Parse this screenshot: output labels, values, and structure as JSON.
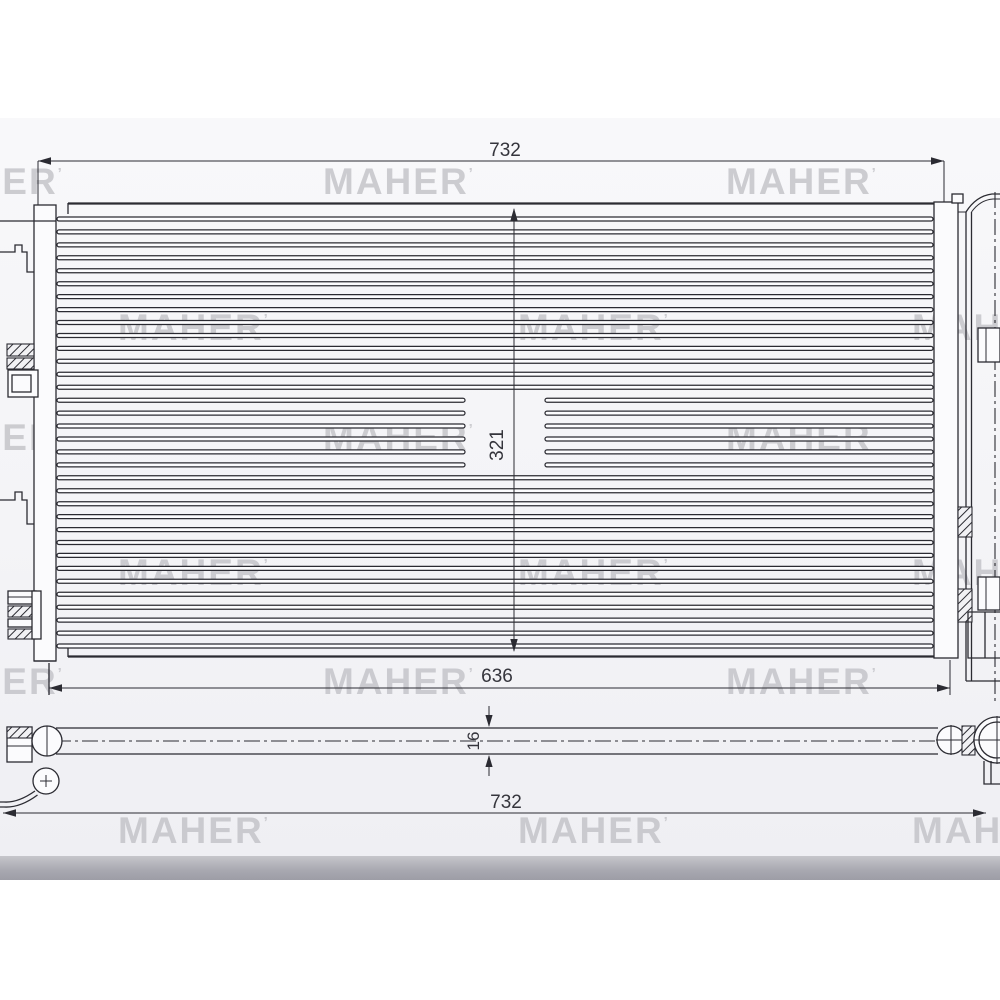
{
  "watermark": {
    "text": "MAHER",
    "mark": "’"
  },
  "dimensions": {
    "top_width": "732",
    "core_height": "321",
    "lower_width": "636",
    "thickness": "16",
    "bottom_width": "732"
  },
  "colors": {
    "line": "#2b2b32",
    "dim_text": "#35353c",
    "watermark": "#c2c2c7",
    "paper": "#f4f4f7",
    "page_edge": "#a8a8b0"
  }
}
